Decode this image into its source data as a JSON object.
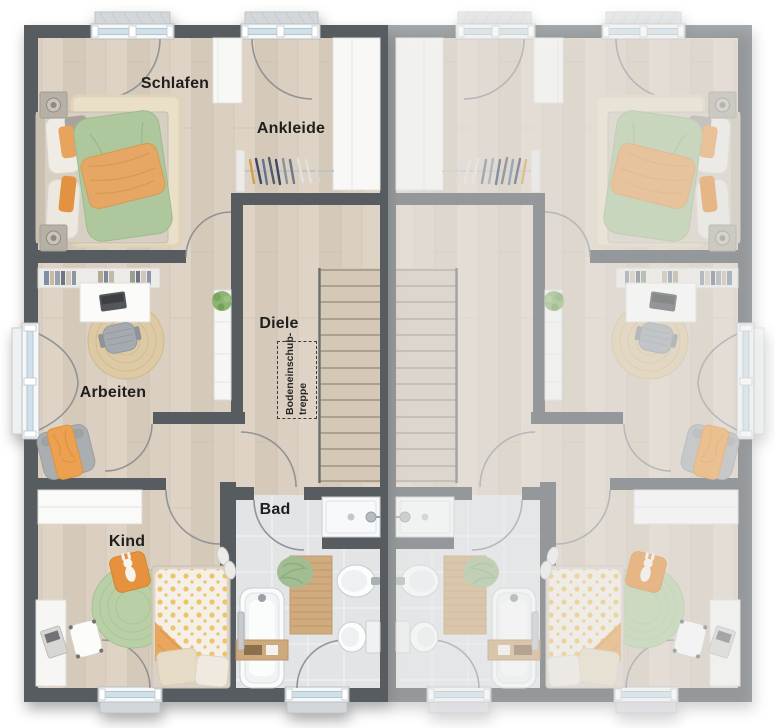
{
  "plan": {
    "type": "floor-plan-top-view",
    "description": "Upper floor plan of a semi-detached house; left unit furnished and labeled, right unit mirrored and faded",
    "rooms": [
      {
        "id": "schlafen",
        "label": "Schlafen"
      },
      {
        "id": "ankleide",
        "label": "Ankleide"
      },
      {
        "id": "diele",
        "label": "Diele"
      },
      {
        "id": "arbeiten",
        "label": "Arbeiten"
      },
      {
        "id": "kind",
        "label": "Kind"
      },
      {
        "id": "bad",
        "label": "Bad"
      }
    ],
    "attic_hatch_label": {
      "line1": "Bodeneinschub-",
      "line2": "treppe"
    },
    "colors": {
      "background": "#ffffff",
      "wall_active": "#575b5e",
      "wall_faded": "#a7abad",
      "floor_wood": "#d9cec0",
      "floor_tile": "#e2e4e6",
      "duvet_green": "#aec79d",
      "blanket_orange": "#e5a763",
      "rug_green": "#b9cfa6",
      "rug_cream": "#eadfc9",
      "rug_jute": "#ddcaa5",
      "glass_blue": "#cfe0ea"
    }
  }
}
